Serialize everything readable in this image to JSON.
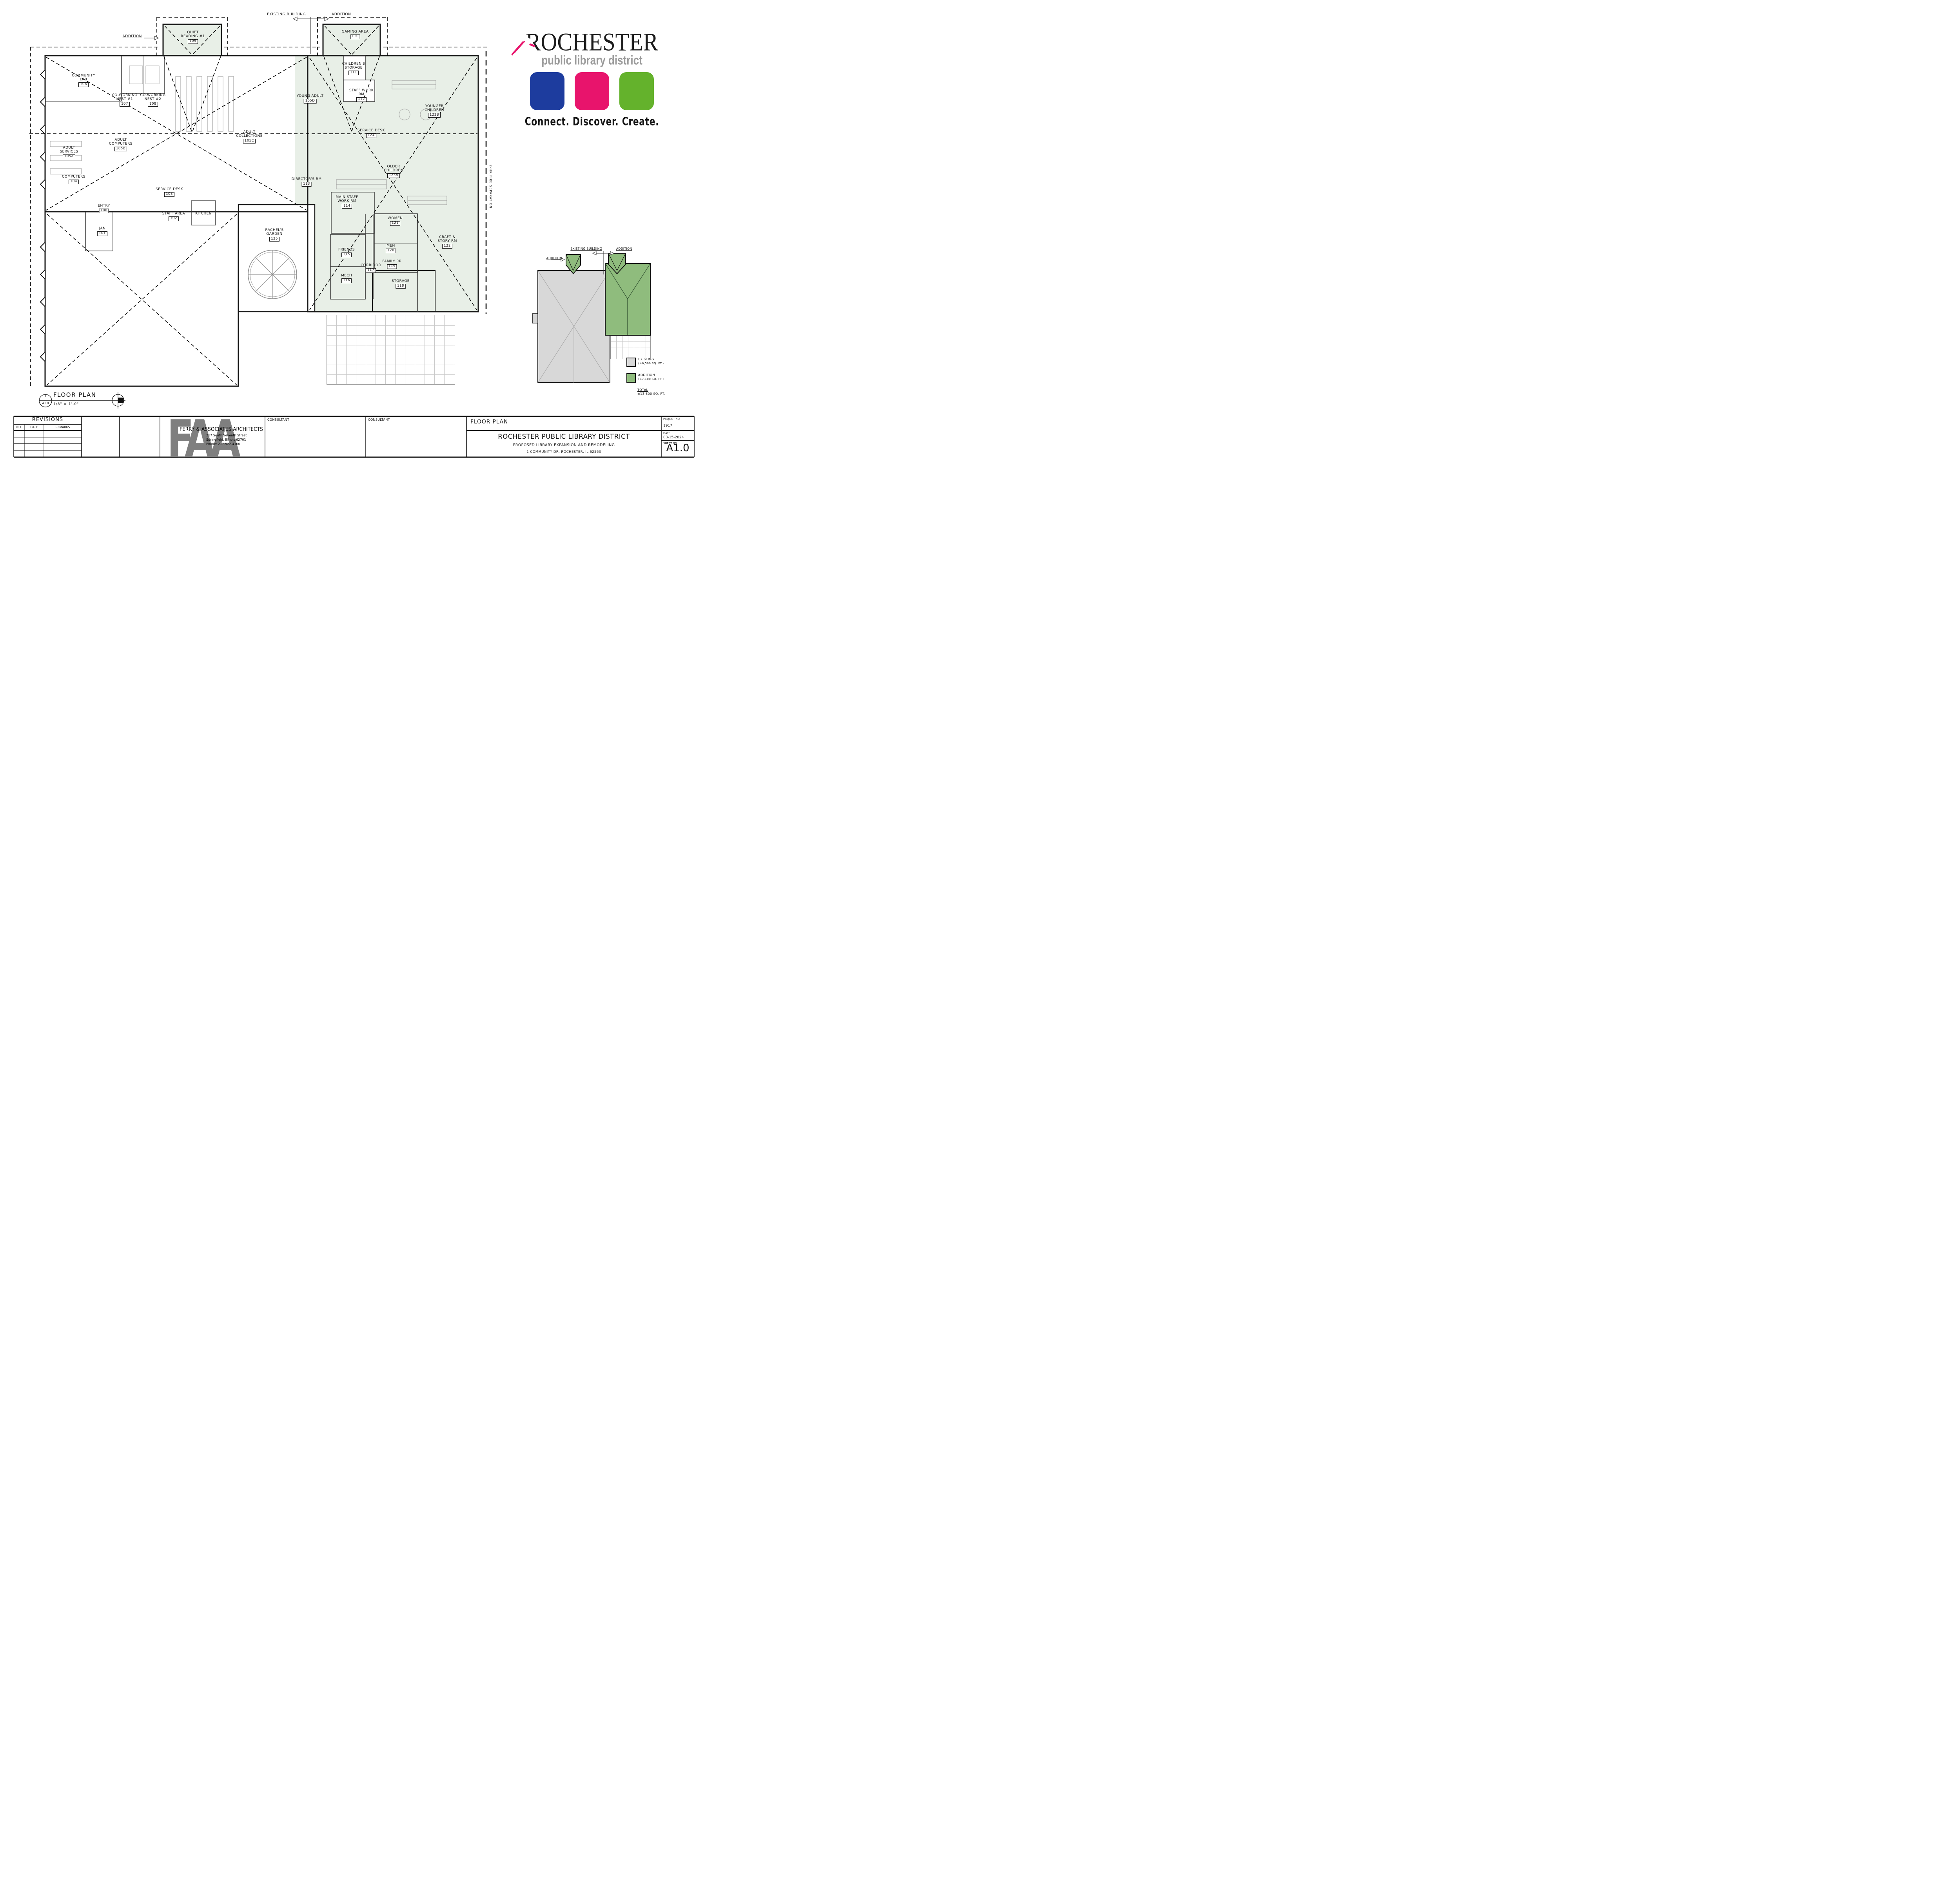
{
  "logo": {
    "name": "ROCHESTER",
    "subtitle": "public library district",
    "tagline": "Connect.  Discover.  Create.",
    "colors": {
      "blue": "#1d3c9e",
      "pink": "#e8146c",
      "green": "#64b22c"
    }
  },
  "rooms": [
    {
      "name": "COMMUNITY LAB",
      "number": "106"
    },
    {
      "name": "CO-WORKING NEST #1",
      "number": "107"
    },
    {
      "name": "CO-WORKING NEST #2",
      "number": "108"
    },
    {
      "name": "QUIET READING #1",
      "number": "109"
    },
    {
      "name": "GAMING AREA",
      "number": "110"
    },
    {
      "name": "CHILDREN'S STORAGE",
      "number": "111"
    },
    {
      "name": "YOUNG ADULT",
      "number": "105D"
    },
    {
      "name": "STAFF WORK RM",
      "number": "112"
    },
    {
      "name": "ADULT COLLECTIONS",
      "number": "105C"
    },
    {
      "name": "ADULT SERVICES",
      "number": "105A"
    },
    {
      "name": "ADULT COMPUTERS",
      "number": "105B"
    },
    {
      "name": "COMPUTERS",
      "number": "104"
    },
    {
      "name": "YOUNGER CHILDREN",
      "number": "123B"
    },
    {
      "name": "SERVICE DESK",
      "number": "124"
    },
    {
      "name": "OLDER CHILDREN",
      "number": "123A"
    },
    {
      "name": "DIRECTOR'S RM",
      "number": "113"
    },
    {
      "name": "MAIN STAFF WORK RM",
      "number": "114"
    },
    {
      "name": "WOMEN",
      "number": "121"
    },
    {
      "name": "MEN",
      "number": "120"
    },
    {
      "name": "CRAFT & STORY RM",
      "number": "122"
    },
    {
      "name": "FRIENDS",
      "number": "115"
    },
    {
      "name": "MECH",
      "number": "116"
    },
    {
      "name": "CORRIDOR",
      "number": "117"
    },
    {
      "name": "FAMILY RR",
      "number": "119"
    },
    {
      "name": "STORAGE",
      "number": "118"
    },
    {
      "name": "RACHEL'S GARDEN",
      "number": "125"
    },
    {
      "name": "SERVICE DESK",
      "number": "103"
    },
    {
      "name": "STAFF AREA",
      "number": "102"
    },
    {
      "name": "KITCHEN",
      "number": ""
    },
    {
      "name": "ENTRY",
      "number": "100"
    },
    {
      "name": "JAN",
      "number": "101"
    }
  ],
  "annotations": {
    "existing_building": "EXISTING BUILDING",
    "addition": "ADDITION",
    "fire_separation": "2-HR FIRE SEPARATION"
  },
  "drawing_title": {
    "detail_no": "1",
    "sheet_ref": "A1.0",
    "title": "FLOOR PLAN",
    "scale": "1/8\" = 1'-0\""
  },
  "key_plan": {
    "addition_left": "ADDITION",
    "existing": "EXISTING BUILDING",
    "addition_right": "ADDITION"
  },
  "legend": {
    "existing_label": "EXISTING",
    "existing_area": "(±6,500 SQ. FT.)",
    "addition_label": "ADDITION",
    "addition_area": "(±7,100 SQ. FT.)",
    "total_label": "TOTAL",
    "total_area": "±13,600 SQ. FT."
  },
  "title_block": {
    "revisions": {
      "title": "REVISIONS",
      "columns": [
        "NO.",
        "DATE",
        "REMARKS"
      ]
    },
    "architect": {
      "monogram": "FAA",
      "name": "FERRY & ASSOCIATES ARCHITECTS",
      "address_line1": "217  South  Seventh  Street",
      "address_line2": "Springfield,   Illinois   62701",
      "address_line3": "Phone:          217-522-4100"
    },
    "consultant1_label": "CONSULTANT",
    "consultant2_label": "CONSULTANT",
    "project": {
      "sheet_title": "FLOOR PLAN",
      "client": "ROCHESTER PUBLIC LIBRARY DISTRICT",
      "description": "PROPOSED LIBRARY EXPANSION AND REMODELING",
      "address": "1 COMMUNITY DR, ROCHESTER, IL 62563"
    },
    "meta": {
      "project_no_label": "PROJECT NO.",
      "project_no": "1917",
      "date_label": "DATE",
      "date": "03-15-2024",
      "sheet_no_label": "SHEET NO.",
      "sheet_no": "A1.0"
    }
  }
}
